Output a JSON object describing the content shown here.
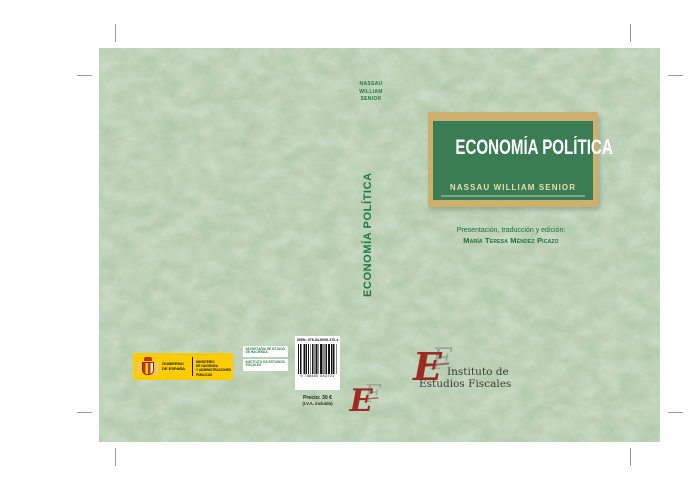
{
  "page": {
    "title": "Economía Política — cubierta del libro"
  },
  "colors": {
    "cover_background": "#b3cbad",
    "title_box_green": "#3a7c54",
    "title_box_border_gold": "#cdb06e",
    "spine_text_green": "#1f7a47",
    "front_title_text": "#ffffff",
    "front_author_text": "#e9dfae",
    "credits_text_green": "#1d6e40",
    "monogram_red": "#9e2a22",
    "monogram_gray": "#9aa79a",
    "government_yellow": "#ffcc05",
    "barcode_ink": "#111111",
    "crop_mark_gray": "#9b9b9b"
  },
  "spine": {
    "author_l1": "NASSAU",
    "author_l2": "WILLIAM",
    "author_l3": "SENIOR",
    "title": "ECONOMÍA POLÍTICA"
  },
  "monogram": {
    "e": "E",
    "f": "F"
  },
  "front_cover": {
    "title": "ECONOMÍA POLÍTICA",
    "author": "NASSAU WILLIAM SENIOR",
    "credits_heading": "Presentación, traducción y edición:",
    "credits_name": "María Teresa Méndez Picazo",
    "publisher_l1": "Instituto de",
    "publisher_l2": "Estudios Fiscales"
  },
  "back_cover": {
    "government_logo": {
      "gobierno_l1": "GOBIERNO",
      "gobierno_l2": "DE ESPAÑA",
      "ministerio_l1": "MINISTERIO",
      "ministerio_l2": "DE HACIENDA",
      "ministerio_l3": "Y ADMINISTRACIONES PÚBLICAS"
    },
    "department_box": {
      "block1_l1": "SECRETARÍA DE ESTADO",
      "block1_l2": "DE HACIENDA",
      "block2_l1": "INSTITUTO DE ESTUDIOS",
      "block2_l2": "FISCALES"
    },
    "barcode": {
      "isbn": "ISBN: 978-84-8008-370-4",
      "digits": "9 788480 083704",
      "price": "Precio: 30 €",
      "vat_note": "(I.V.A. incluido)"
    }
  }
}
